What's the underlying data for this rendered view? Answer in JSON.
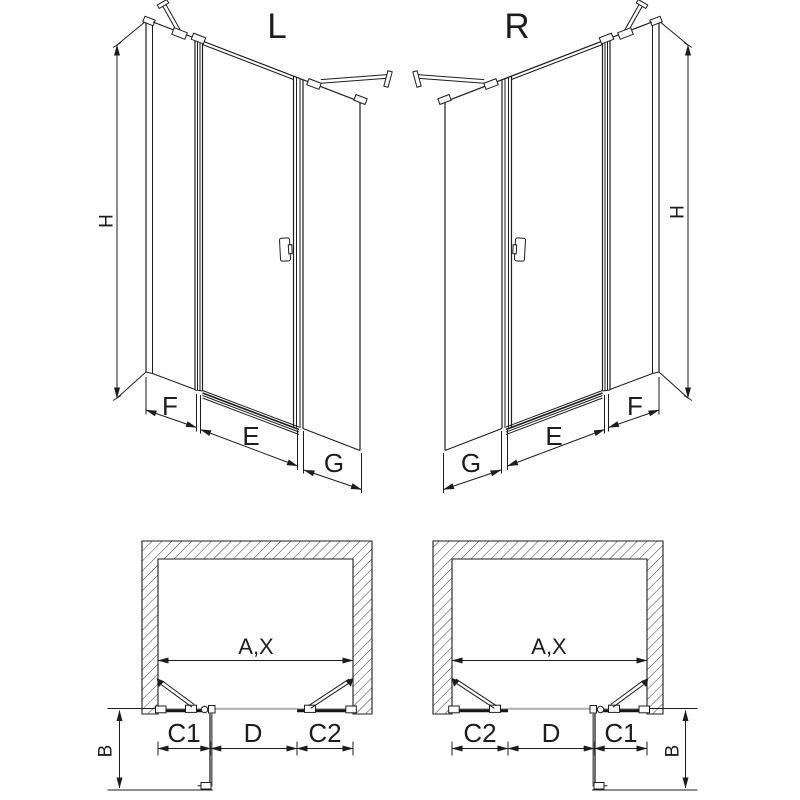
{
  "figure": {
    "left_variant": {
      "title": "L",
      "height_label": "H",
      "bottom_dims": [
        "F",
        "E",
        "G"
      ]
    },
    "right_variant": {
      "title": "R",
      "height_label": "H",
      "bottom_dims": [
        "G",
        "E",
        "F"
      ]
    },
    "left_plan": {
      "width_label": "A,X",
      "bottom_dims": [
        "C1",
        "D",
        "C2"
      ],
      "depth_label": "B"
    },
    "right_plan": {
      "width_label": "A,X",
      "bottom_dims": [
        "C2",
        "D",
        "C1"
      ],
      "depth_label": "B"
    },
    "colors": {
      "line": "#1d1d1d",
      "glass_threshold": "#b3b3b3",
      "open_door": "#6e6e6e",
      "background": "#ffffff"
    }
  }
}
